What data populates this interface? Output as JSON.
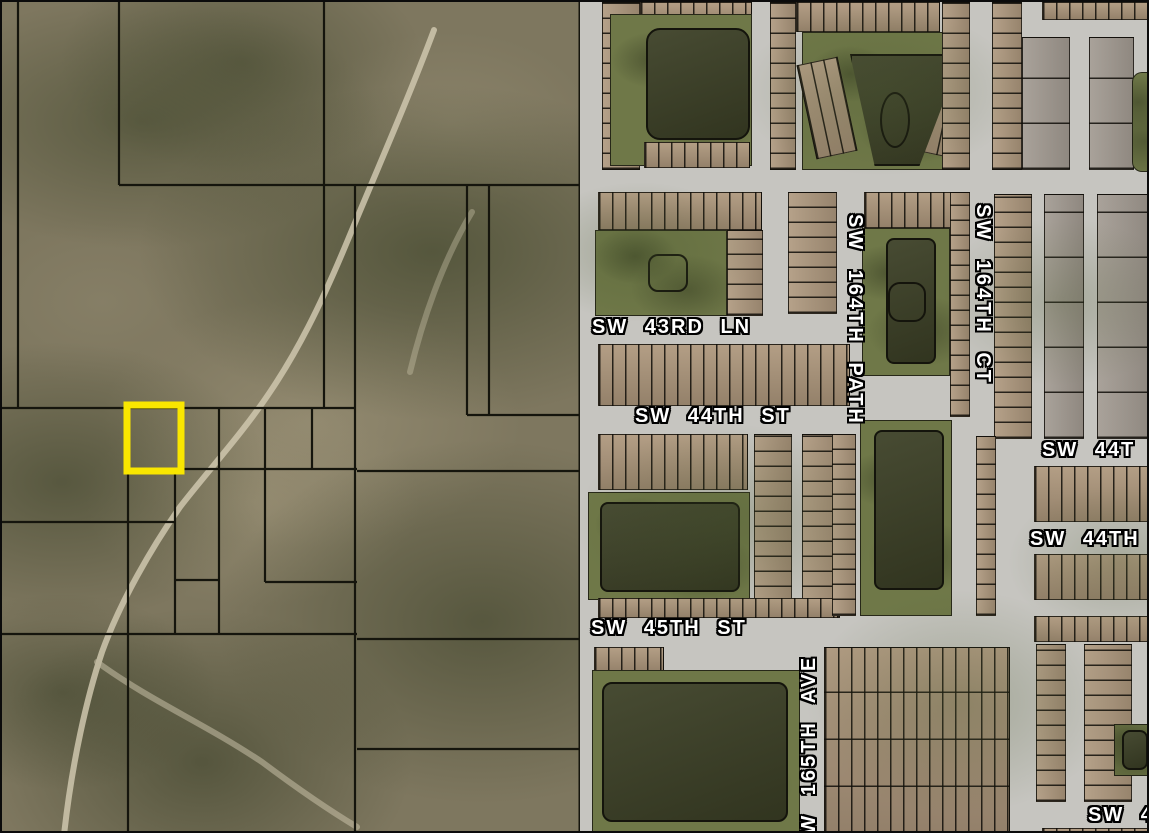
{
  "map": {
    "title": "Aerial parcel map with highlighted parcel",
    "left_area": {
      "type": "undeveloped-land-with-parcel-boundaries"
    },
    "right_area": {
      "type": "residential-subdivision"
    },
    "highlighted_parcel": {
      "description": "yellow-outlined parcel",
      "stroke_color": "#f9e600"
    },
    "street_labels": [
      {
        "id": "sw-43rd-ln",
        "text": "SW 43RD LN",
        "orientation": "horizontal"
      },
      {
        "id": "sw-44th-st",
        "text": "SW 44TH ST",
        "orientation": "horizontal"
      },
      {
        "id": "sw-164th-path",
        "text": "SW 164TH PATH",
        "orientation": "vertical-down"
      },
      {
        "id": "sw-164th-ct",
        "text": "SW 164TH CT",
        "orientation": "vertical-down"
      },
      {
        "id": "sw-44t-right",
        "text": "SW 44T",
        "orientation": "horizontal"
      },
      {
        "id": "sw-44th-right",
        "text": "SW 44TH",
        "orientation": "horizontal"
      },
      {
        "id": "sw-45th-st",
        "text": "SW 45TH ST",
        "orientation": "horizontal"
      },
      {
        "id": "sw-165th-ave",
        "text": "SW 165TH AVE",
        "orientation": "vertical-up"
      },
      {
        "id": "sw-4-bottom",
        "text": "SW 4",
        "orientation": "horizontal"
      }
    ],
    "colors": {
      "street": "#c6c5c0",
      "parcel_line": "#15150d",
      "water": "#3c4026",
      "pond_buffer": "#6f7848",
      "land_base": "#7e775f",
      "vegetation": "#474e30",
      "trail": "#cfc7ae",
      "roof_tan": "#b39e85",
      "highlight": "#f9e600",
      "label_text": "#ffffff",
      "label_outline": "#000000"
    }
  }
}
